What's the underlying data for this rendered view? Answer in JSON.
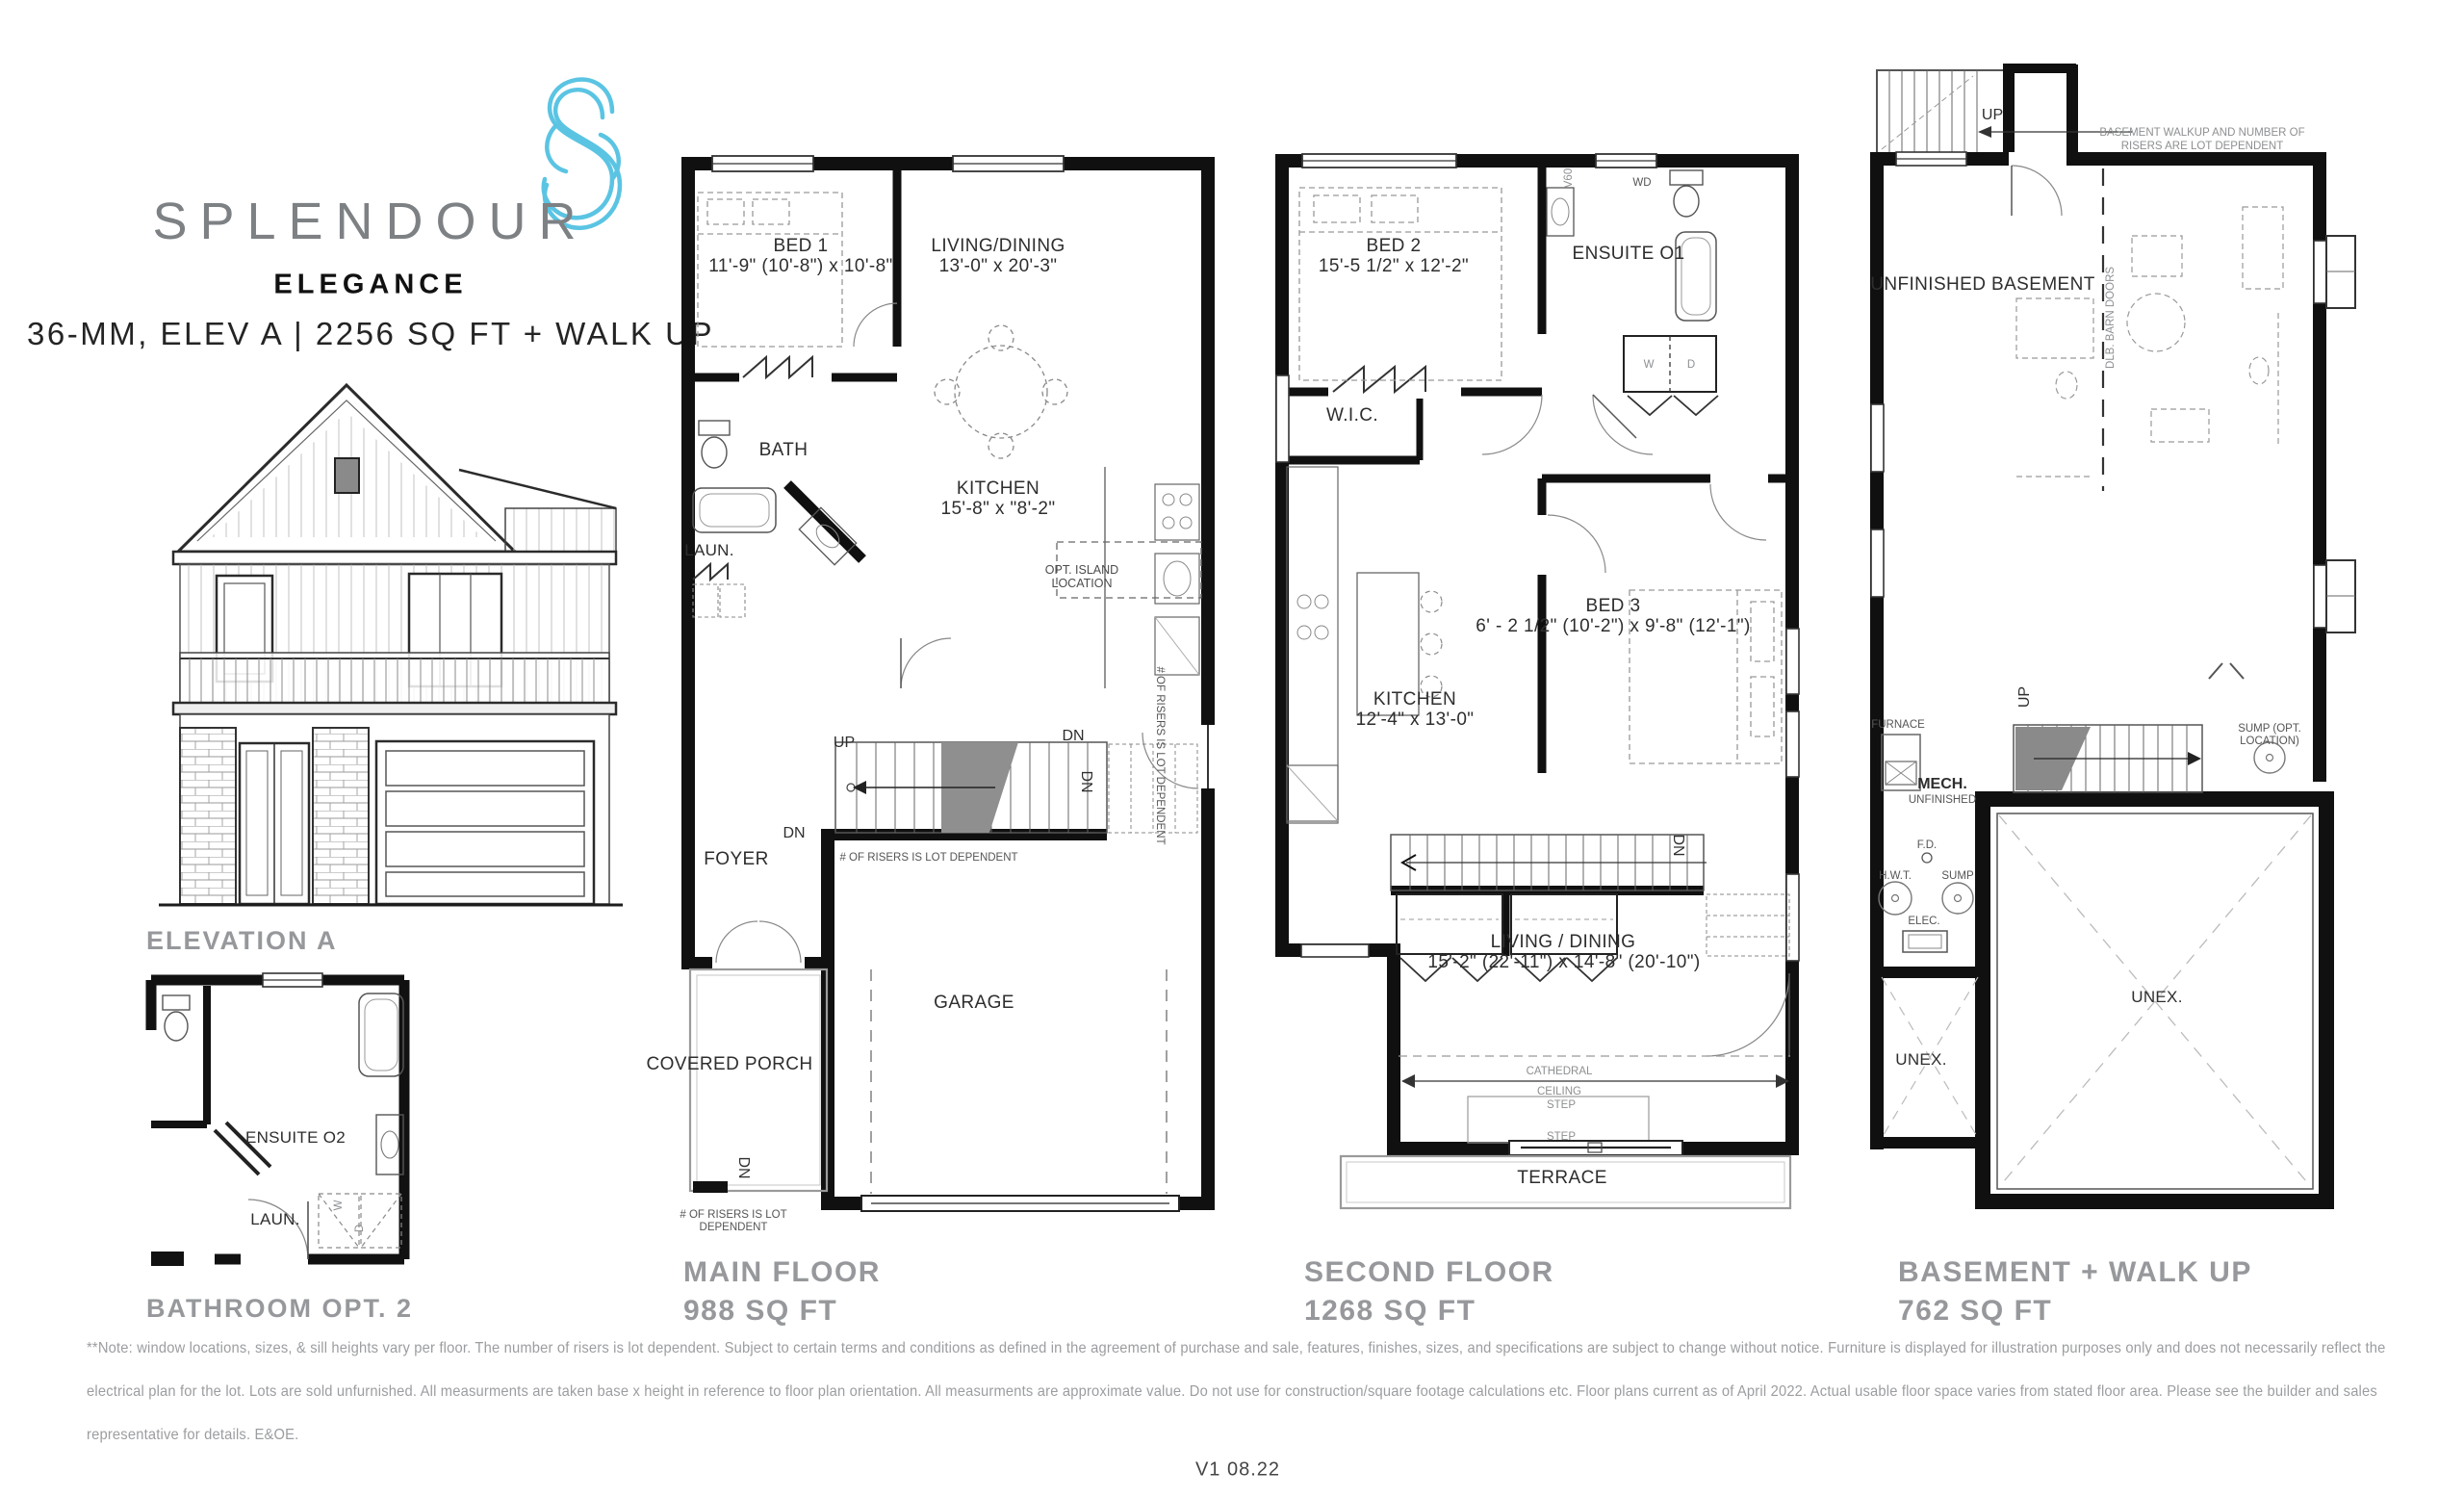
{
  "page": {
    "version": "V1 08.22"
  },
  "brand": {
    "name": "SPLENDOUR",
    "model": "ELEGANCE",
    "spec": "36-MM, ELEV A | 2256 SQ FT + WALK UP",
    "accent_color": "#5BC4E3",
    "gray_color": "#96989B"
  },
  "elevation": {
    "title": "ELEVATION A"
  },
  "bath_option": {
    "title": "BATHROOM OPT. 2",
    "ensuite": "ENSUITE O2",
    "laundry": "LAUN.",
    "washer": "W",
    "dryer": "D"
  },
  "common": {
    "up": "UP",
    "dn": "DN",
    "step": "STEP",
    "unex": "UNEX.",
    "risers_note": "# OF RISERS IS LOT DEPENDENT",
    "risers_note_l1": "# OF RISERS IS LOT",
    "risers_note_l2": "DEPENDENT"
  },
  "main_floor": {
    "title": "MAIN FLOOR",
    "area": "988 SQ FT",
    "bed1": "BED 1",
    "bed1_dims": "11'-9\" (10'-8\") x 10'-8\"",
    "living": "LIVING/DINING",
    "living_dims": "13'-0\" x 20'-3\"",
    "bath": "BATH",
    "kitchen": "KITCHEN",
    "kitchen_dims": "15'-8\" x \"8'-2\"",
    "laundry": "LAUN.",
    "opt_island_l1": "OPT. ISLAND",
    "opt_island_l2": "LOCATION",
    "foyer": "FOYER",
    "garage": "GARAGE",
    "covered_porch": "COVERED PORCH"
  },
  "second_floor": {
    "title": "SECOND FLOOR",
    "area": "1268 SQ FT",
    "bed2": "BED 2",
    "bed2_dims": "15'-5 1/2\" x 12'-2\"",
    "ensuite": "ENSUITE O1",
    "wd": "WD",
    "v60": "V60",
    "wic": "W.I.C.",
    "washer": "W",
    "dryer": "D",
    "bed3": "BED 3",
    "bed3_dims": "6' - 2 1/2\" (10'-2\") x 9'-8\" (12'-1\")",
    "kitchen": "KITCHEN",
    "kitchen_dims": "12'-4\" x 13'-0\"",
    "living": "LIVING / DINING",
    "living_dims": "15'-2\" (22'-11\") x 14'-8\" (20'-10\")",
    "cathedral_l1": "CATHEDRAL",
    "cathedral_l2": "CEILING",
    "terrace": "TERRACE"
  },
  "basement": {
    "title": "BASEMENT + WALK UP",
    "area": "762 SQ FT",
    "walkup_note_l1": "BASEMENT WALKUP AND NUMBER OF",
    "walkup_note_l2": "RISERS ARE LOT DEPENDENT",
    "unfinished": "UNFINISHED BASEMENT",
    "barn_doors": "DLB. BARN DOORS",
    "furnace": "FURNACE",
    "mech": "MECH.",
    "mech_sub": "UNFINISHED",
    "fd": "F.D.",
    "hwt": "H.W.T.",
    "sump": "SUMP",
    "elec": "ELEC.",
    "sump_opt_l1": "SUMP (OPT.",
    "sump_opt_l2": "LOCATION)"
  },
  "disclaimer": {
    "line1": "**Note: window locations, sizes, & sill heights vary per floor. The number of risers is lot dependent. Subject to certain terms and conditions as defined in the agreement of purchase and sale, features, finishes, sizes, and specifications are subject to change without notice. Furniture is displayed for illustration purposes only and does not necessarily reflect the",
    "line2": "electrical plan for the lot. Lots are sold unfurnished. All measurments are taken base x height in reference to floor plan orientation. All measurments are approximate value. Do not use for construction/square footage calculations etc. Floor plans current as of April 2022. Actual usable floor space varies from stated floor area. Please see the builder and sales",
    "line3": "representative for details. E&OE."
  }
}
